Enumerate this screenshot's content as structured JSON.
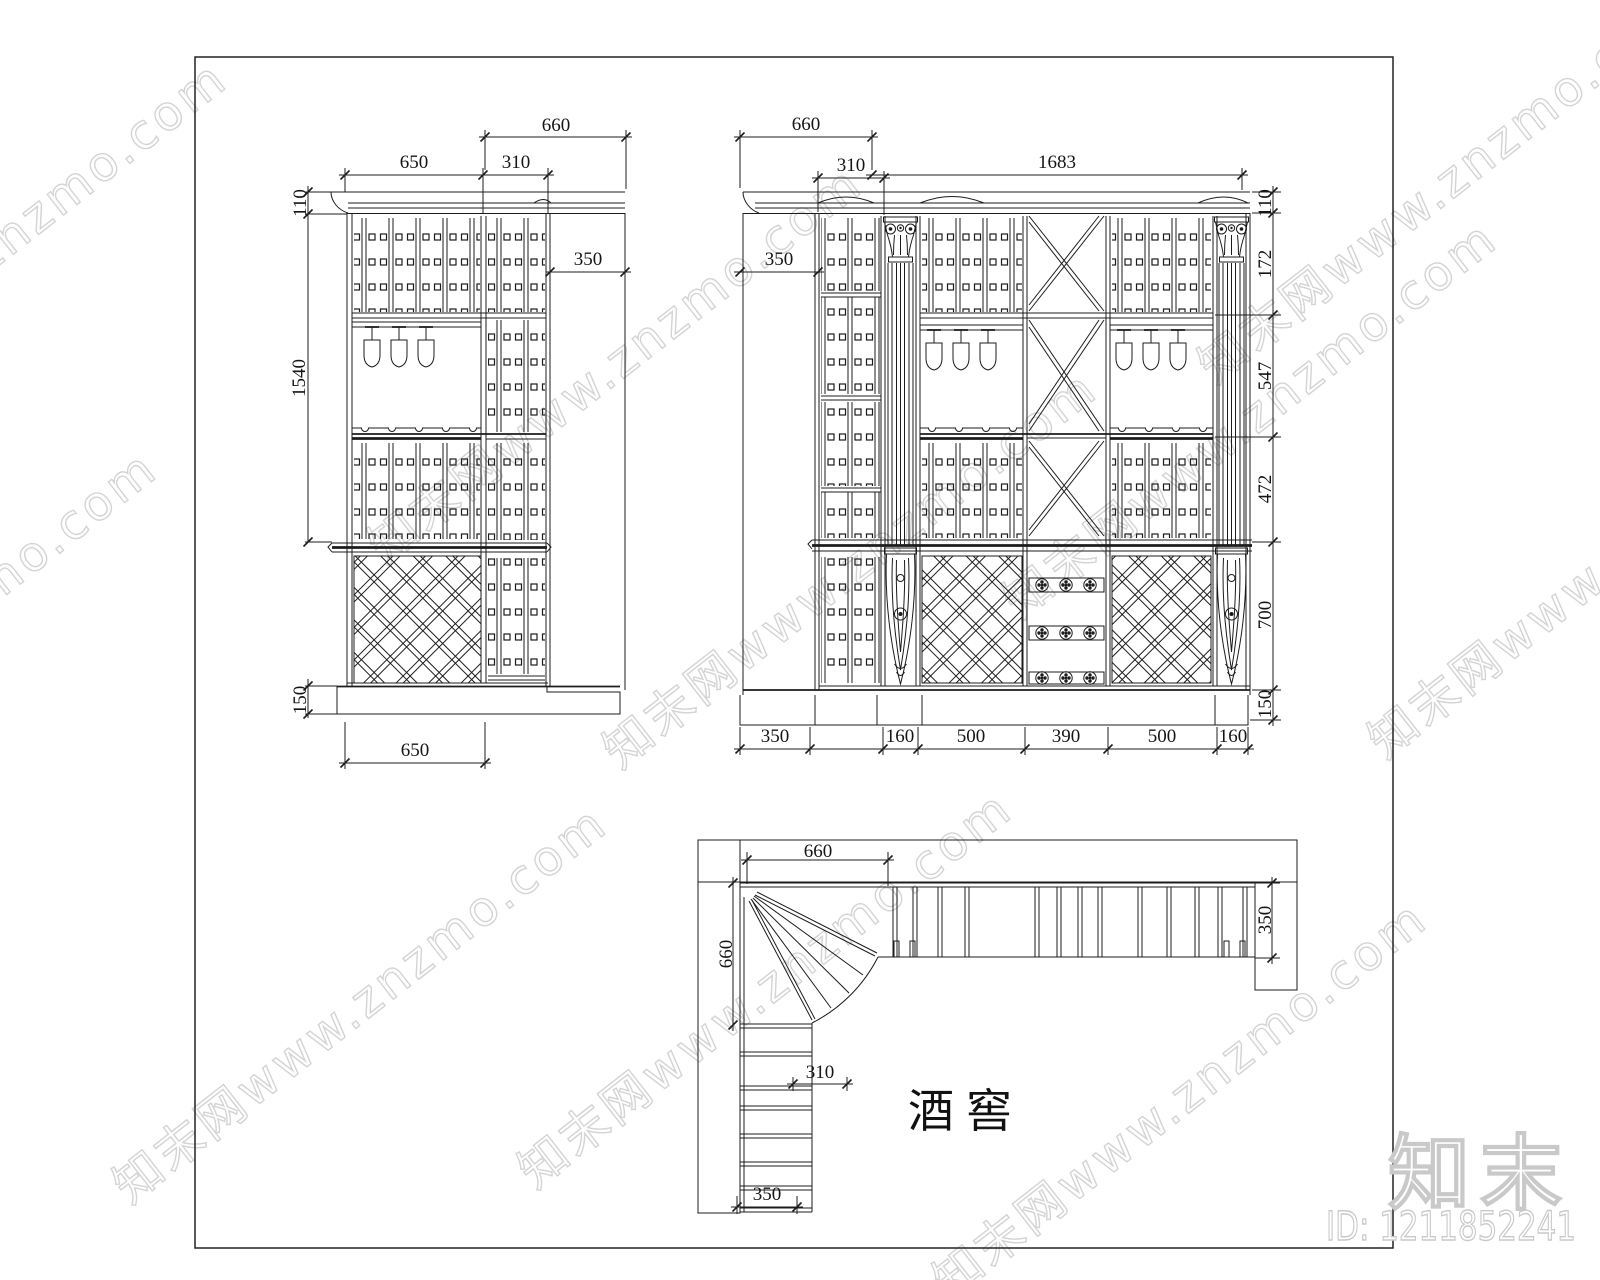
{
  "watermark": {
    "tile_text": "知末网www.znzmo.com",
    "logo_text": "知末",
    "id_label": "ID: 1211852241",
    "tile_color": "#d4d4d4",
    "outline_color": "#c9c9c9"
  },
  "left_elevation": {
    "dims": {
      "top_return": "660",
      "width_left": "650",
      "width_right": "310",
      "cornice": "110",
      "upper_height": "1540",
      "return_depth": "350",
      "base": "150",
      "bottom_width": "650"
    }
  },
  "right_elevation": {
    "dims": {
      "top_return": "660",
      "width_left": "310",
      "total_width": "1683",
      "return_depth": "350",
      "cornice": "110",
      "capital": "172",
      "upper": "547",
      "middle": "472",
      "lower": "700",
      "base": "150",
      "bottom": [
        "350",
        "160",
        "500",
        "390",
        "500",
        "160"
      ]
    }
  },
  "plan": {
    "dims": {
      "top_width": "660",
      "left_depth": "660",
      "side_width": "310",
      "right_depth": "350",
      "bottom_depth": "350"
    },
    "room_label": "酒窖"
  }
}
